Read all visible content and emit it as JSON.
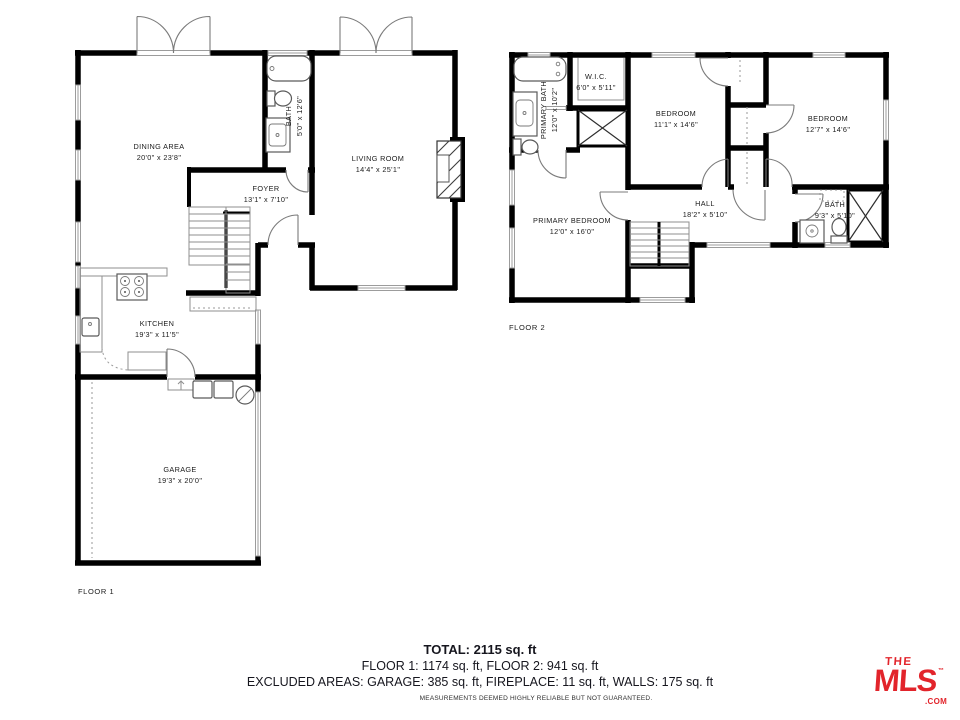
{
  "floor1": {
    "name": "FLOOR 1",
    "rooms": {
      "dining": {
        "label": "DINING AREA",
        "dims": "20'0\" x 23'8\""
      },
      "bath": {
        "label": "BATH",
        "dims": "5'0\" x 12'6\""
      },
      "living": {
        "label": "LIVING ROOM",
        "dims": "14'4\" x 25'1\""
      },
      "foyer": {
        "label": "FOYER",
        "dims": "13'1\" x 7'10\""
      },
      "kitchen": {
        "label": "KITCHEN",
        "dims": "19'3\" x 11'5\""
      },
      "garage": {
        "label": "GARAGE",
        "dims": "19'3\" x 20'0\""
      }
    }
  },
  "floor2": {
    "name": "FLOOR 2",
    "rooms": {
      "primary_bath": {
        "label": "PRIMARY BATH",
        "dims": "12'0\" x 10'2\""
      },
      "wic": {
        "label": "W.I.C.",
        "dims": "6'0\" x 5'11\""
      },
      "bedroom_left": {
        "label": "BEDROOM",
        "dims": "11'1\" x 14'6\""
      },
      "bedroom_right": {
        "label": "BEDROOM",
        "dims": "12'7\" x 14'6\""
      },
      "primary_bedroom": {
        "label": "PRIMARY BEDROOM",
        "dims": "12'0\" x 16'0\""
      },
      "hall": {
        "label": "HALL",
        "dims": "18'2\" x 5'10\""
      },
      "bath": {
        "label": "BATH",
        "dims": "9'3\" x 5'10\""
      }
    }
  },
  "summary": {
    "total": "TOTAL: 2115 sq. ft",
    "floors": "FLOOR 1: 1174 sq. ft, FLOOR 2: 941 sq. ft",
    "excluded": "EXCLUDED AREAS: GARAGE: 385 sq. ft, FIREPLACE: 11 sq. ft, WALLS: 175 sq. ft",
    "disclaimer": "MEASUREMENTS DEEMED HIGHLY RELIABLE BUT NOT GUARANTEED."
  },
  "logo": {
    "line1": "THE",
    "line2": "MLS",
    "tm": "™",
    "suffix": ".COM",
    "color": "#E2242B"
  }
}
